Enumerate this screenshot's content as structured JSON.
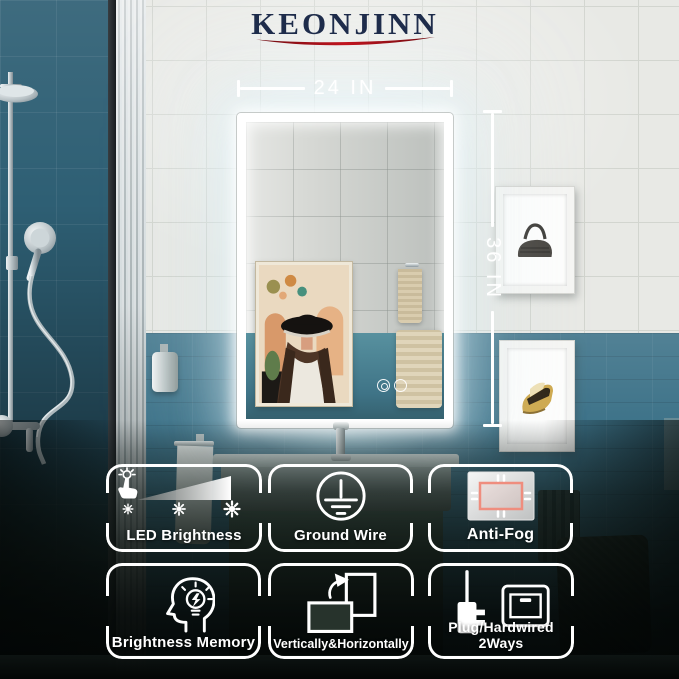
{
  "brand": {
    "name": "KEONJINN"
  },
  "dimension_labels": {
    "width": "24 IN",
    "height": "36 IN"
  },
  "features": [
    {
      "label": "LED Brightness",
      "icon": "touch-dimmer-icon"
    },
    {
      "label": "Ground Wire",
      "icon": "ground-wire-icon"
    },
    {
      "label": "Anti-Fog",
      "icon": "anti-fog-mirror-icon"
    },
    {
      "label": "Brightness Memory",
      "icon": "brightness-memory-icon"
    },
    {
      "label": "Vertically&Horizontally",
      "icon": "rotate-orientation-icon"
    },
    {
      "label": "Plug/Hardwired 2Ways",
      "icon": "plug-hardwired-icon"
    }
  ],
  "colors": {
    "brand_text": "#1e2c4b",
    "brand_swoosh": "#b1131d",
    "teal_wall": "#33687c",
    "white_tile": "#e8e9e5",
    "led_white": "#ffffff",
    "badge_outline": "#ffffff",
    "anti_fog_accent": "#ef8d7e"
  }
}
